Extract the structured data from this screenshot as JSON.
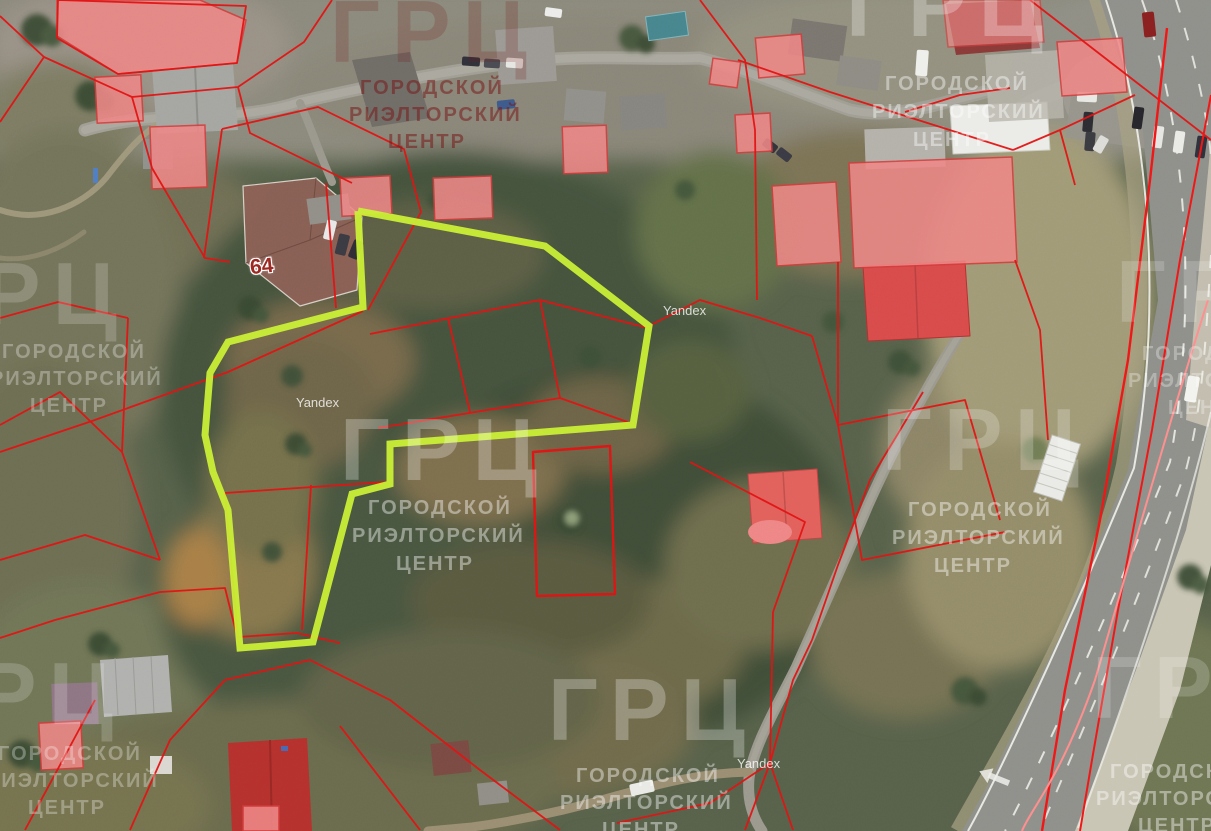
{
  "map": {
    "provider_watermark": "Yandex",
    "house_number_label": "64"
  },
  "agency_watermark": {
    "abbr": "ГРЦ",
    "line1": "ГОРОДСКОЙ",
    "line2": "РИЭЛТОРСКИЙ",
    "line3": "ЦЕНТР"
  },
  "colors": {
    "highlighted_parcel_outline": "#c9ef35",
    "cadastral_line": "#e31212",
    "building_footprint_fill": "#ee8686",
    "red_roof": "#d84b4b",
    "highway_marking_red": "#f21616"
  }
}
